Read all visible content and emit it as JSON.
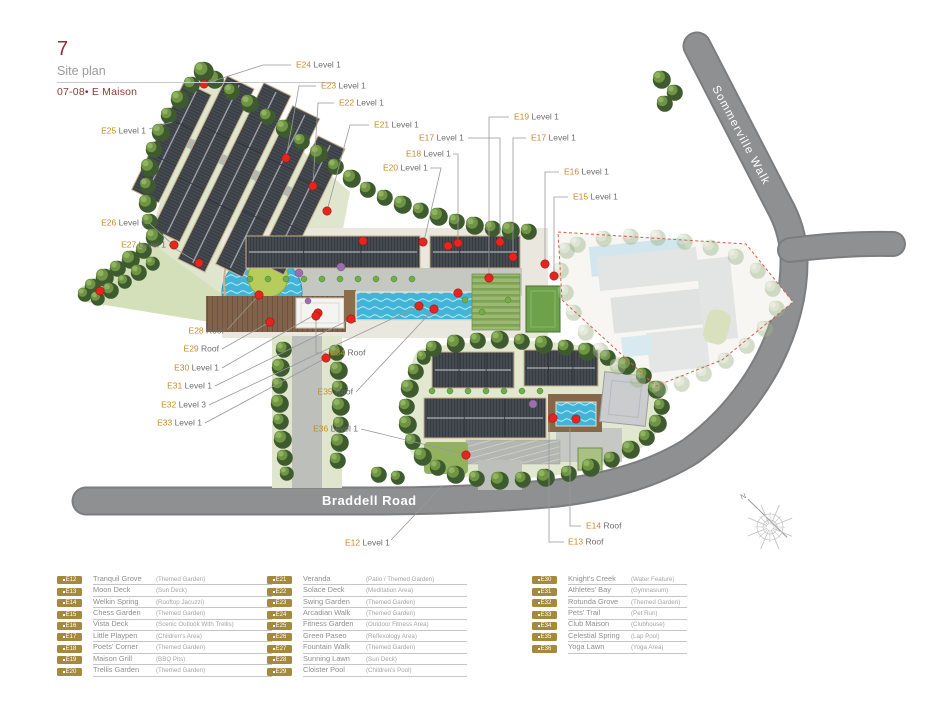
{
  "header": {
    "page_number": "7",
    "title": "Site plan",
    "subtitle": "07-08• E Maison"
  },
  "map": {
    "roads": {
      "braddell": "Braddell Road",
      "sommerville": "Sommerville Walk"
    },
    "compass_north": "N",
    "label_color": "#c8882b",
    "marker_color": "#e6251f",
    "future_boundary_color": "#d4604d",
    "labels": [
      {
        "id": "E24",
        "level": "Level 1"
      },
      {
        "id": "E23",
        "level": "Level 1"
      },
      {
        "id": "E22",
        "level": "Level 1"
      },
      {
        "id": "E21",
        "level": "Level 1"
      },
      {
        "id": "E19",
        "level": "Level 1"
      },
      {
        "id": "E17",
        "level": "Level 1"
      },
      {
        "id": "E18",
        "level": "Level 1"
      },
      {
        "id": "E20",
        "level": "Level 1"
      },
      {
        "id": "E17",
        "level": "Level 1"
      },
      {
        "id": "E16",
        "level": "Level 1"
      },
      {
        "id": "E15",
        "level": "Level 1"
      },
      {
        "id": "E25",
        "level": "Level 1"
      },
      {
        "id": "E26",
        "level": "Level 1"
      },
      {
        "id": "E27",
        "level": "Level 1"
      },
      {
        "id": "E28",
        "level": "Roof"
      },
      {
        "id": "E29",
        "level": "Roof"
      },
      {
        "id": "E30",
        "level": "Level 1"
      },
      {
        "id": "E31",
        "level": "Level 1"
      },
      {
        "id": "E32",
        "level": "Level 3"
      },
      {
        "id": "E33",
        "level": "Level 1"
      },
      {
        "id": "E34",
        "level": "Roof"
      },
      {
        "id": "E35",
        "level": "Roof"
      },
      {
        "id": "E36",
        "level": "Level 1"
      },
      {
        "id": "E12",
        "level": "Level 1"
      },
      {
        "id": "E13",
        "level": "Roof"
      },
      {
        "id": "E14",
        "level": "Roof"
      }
    ]
  },
  "legend": {
    "badge_color": "#a5893c",
    "columns": [
      {
        "items": [
          {
            "id": "E12",
            "name": "Tranquil Grove",
            "desc": "(Themed Garden)"
          },
          {
            "id": "E13",
            "name": "Moon Deck",
            "desc": "(Sun Deck)"
          },
          {
            "id": "E14",
            "name": "Welkin Spring",
            "desc": "(Rooftop Jacuzzi)"
          },
          {
            "id": "E15",
            "name": "Chess Garden",
            "desc": "(Themed Garden)"
          },
          {
            "id": "E16",
            "name": "Vista Deck",
            "desc": "(Scenic Outlook With Trellis)"
          },
          {
            "id": "E17",
            "name": "Little Playpen",
            "desc": "(Children's Area)"
          },
          {
            "id": "E18",
            "name": "Poets' Corner",
            "desc": "(Themed Garden)"
          },
          {
            "id": "E19",
            "name": "Maison Grill",
            "desc": "(BBQ Pits)"
          },
          {
            "id": "E20",
            "name": "Trellis Garden",
            "desc": "(Themed Garden)"
          }
        ]
      },
      {
        "items": [
          {
            "id": "E21",
            "name": "Veranda",
            "desc": "(Patio / Themed Garden)"
          },
          {
            "id": "E22",
            "name": "Solace Deck",
            "desc": "(Meditation Area)"
          },
          {
            "id": "E23",
            "name": "Swing Garden",
            "desc": "(Themed Garden)"
          },
          {
            "id": "E24",
            "name": "Arcadian Walk",
            "desc": "(Themed Garden)"
          },
          {
            "id": "E25",
            "name": "Fitness Garden",
            "desc": "(Outdoor Fitness Area)"
          },
          {
            "id": "E26",
            "name": "Green Paseo",
            "desc": "(Reflexology Area)"
          },
          {
            "id": "E27",
            "name": "Fountain Walk",
            "desc": "(Themed Garden)"
          },
          {
            "id": "E28",
            "name": "Sunning Lawn",
            "desc": "(Sun Deck)"
          },
          {
            "id": "E29",
            "name": "Cloister Pool",
            "desc": "(Children's Pool)"
          }
        ]
      },
      {
        "items": [
          {
            "id": "E30",
            "name": "Knight's Creek",
            "desc": "(Water Feature)"
          },
          {
            "id": "E31",
            "name": "Athletes' Bay",
            "desc": "(Gymnasium)"
          },
          {
            "id": "E32",
            "name": "Rotunda Grove",
            "desc": "(Themed Garden)"
          },
          {
            "id": "E33",
            "name": "Pets' Trail",
            "desc": "(Pet Run)"
          },
          {
            "id": "E34",
            "name": "Club Maison",
            "desc": "(Clubhouse)"
          },
          {
            "id": "E35",
            "name": "Celestial Spring",
            "desc": "(Lap Pool)"
          },
          {
            "id": "E36",
            "name": "Yoga Lawn",
            "desc": "(Yoga Area)"
          }
        ]
      }
    ]
  }
}
